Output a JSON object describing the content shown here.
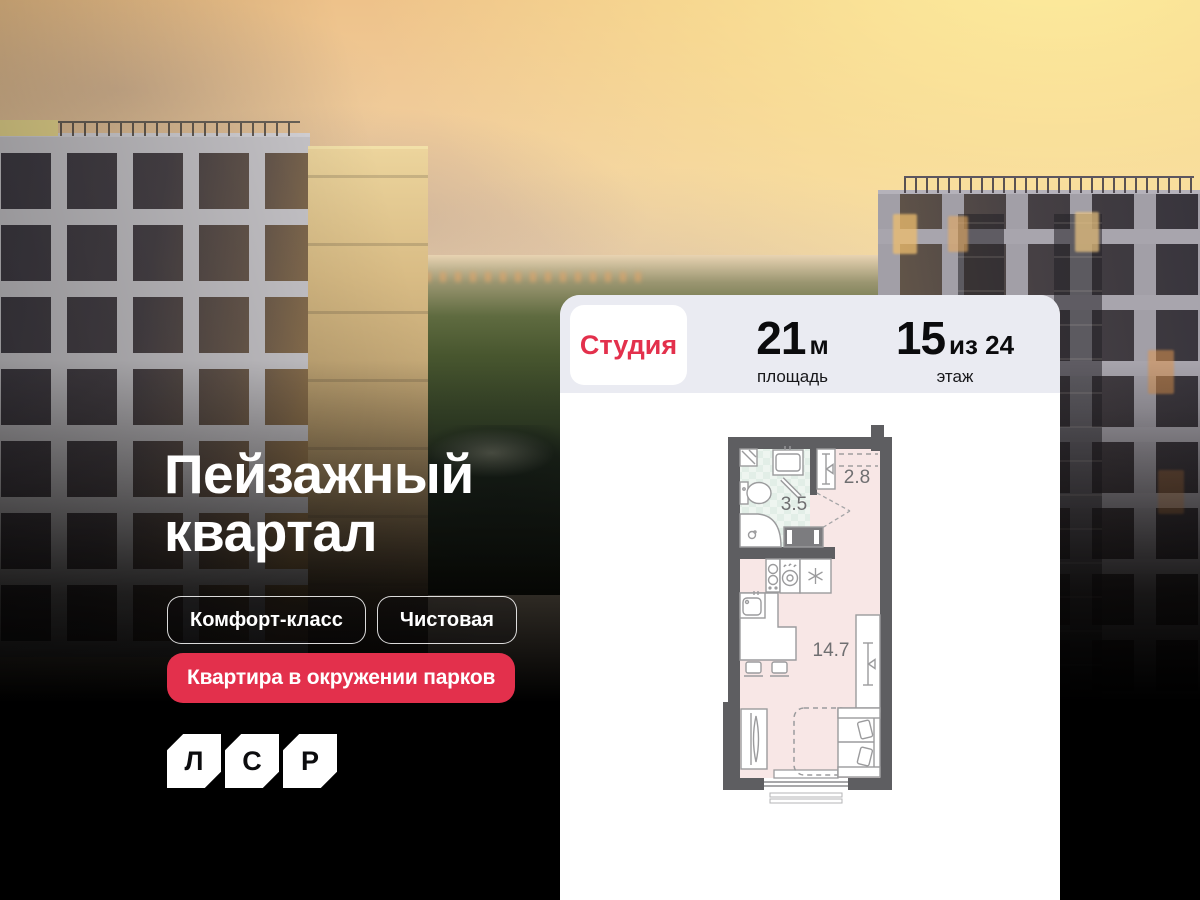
{
  "hero": {
    "title": "Пейзажный квартал",
    "badges": [
      "Комфорт-класс",
      "Чистовая"
    ],
    "highlight_badge": "Квартира в окружении парков",
    "logo": {
      "letters": [
        "Л",
        "С",
        "Р"
      ]
    }
  },
  "card": {
    "type_label": "Студия",
    "stats": [
      {
        "value": "21",
        "suffix": "м",
        "label": "площадь"
      },
      {
        "value": "15",
        "suffix": "из 24",
        "label": "этаж"
      }
    ],
    "plan_areas": {
      "bathroom": "3.5",
      "hallway": "2.8",
      "living": "14.7"
    }
  },
  "colors": {
    "accent_red": "#E3304C",
    "header_bg": "#EAEBF2"
  }
}
